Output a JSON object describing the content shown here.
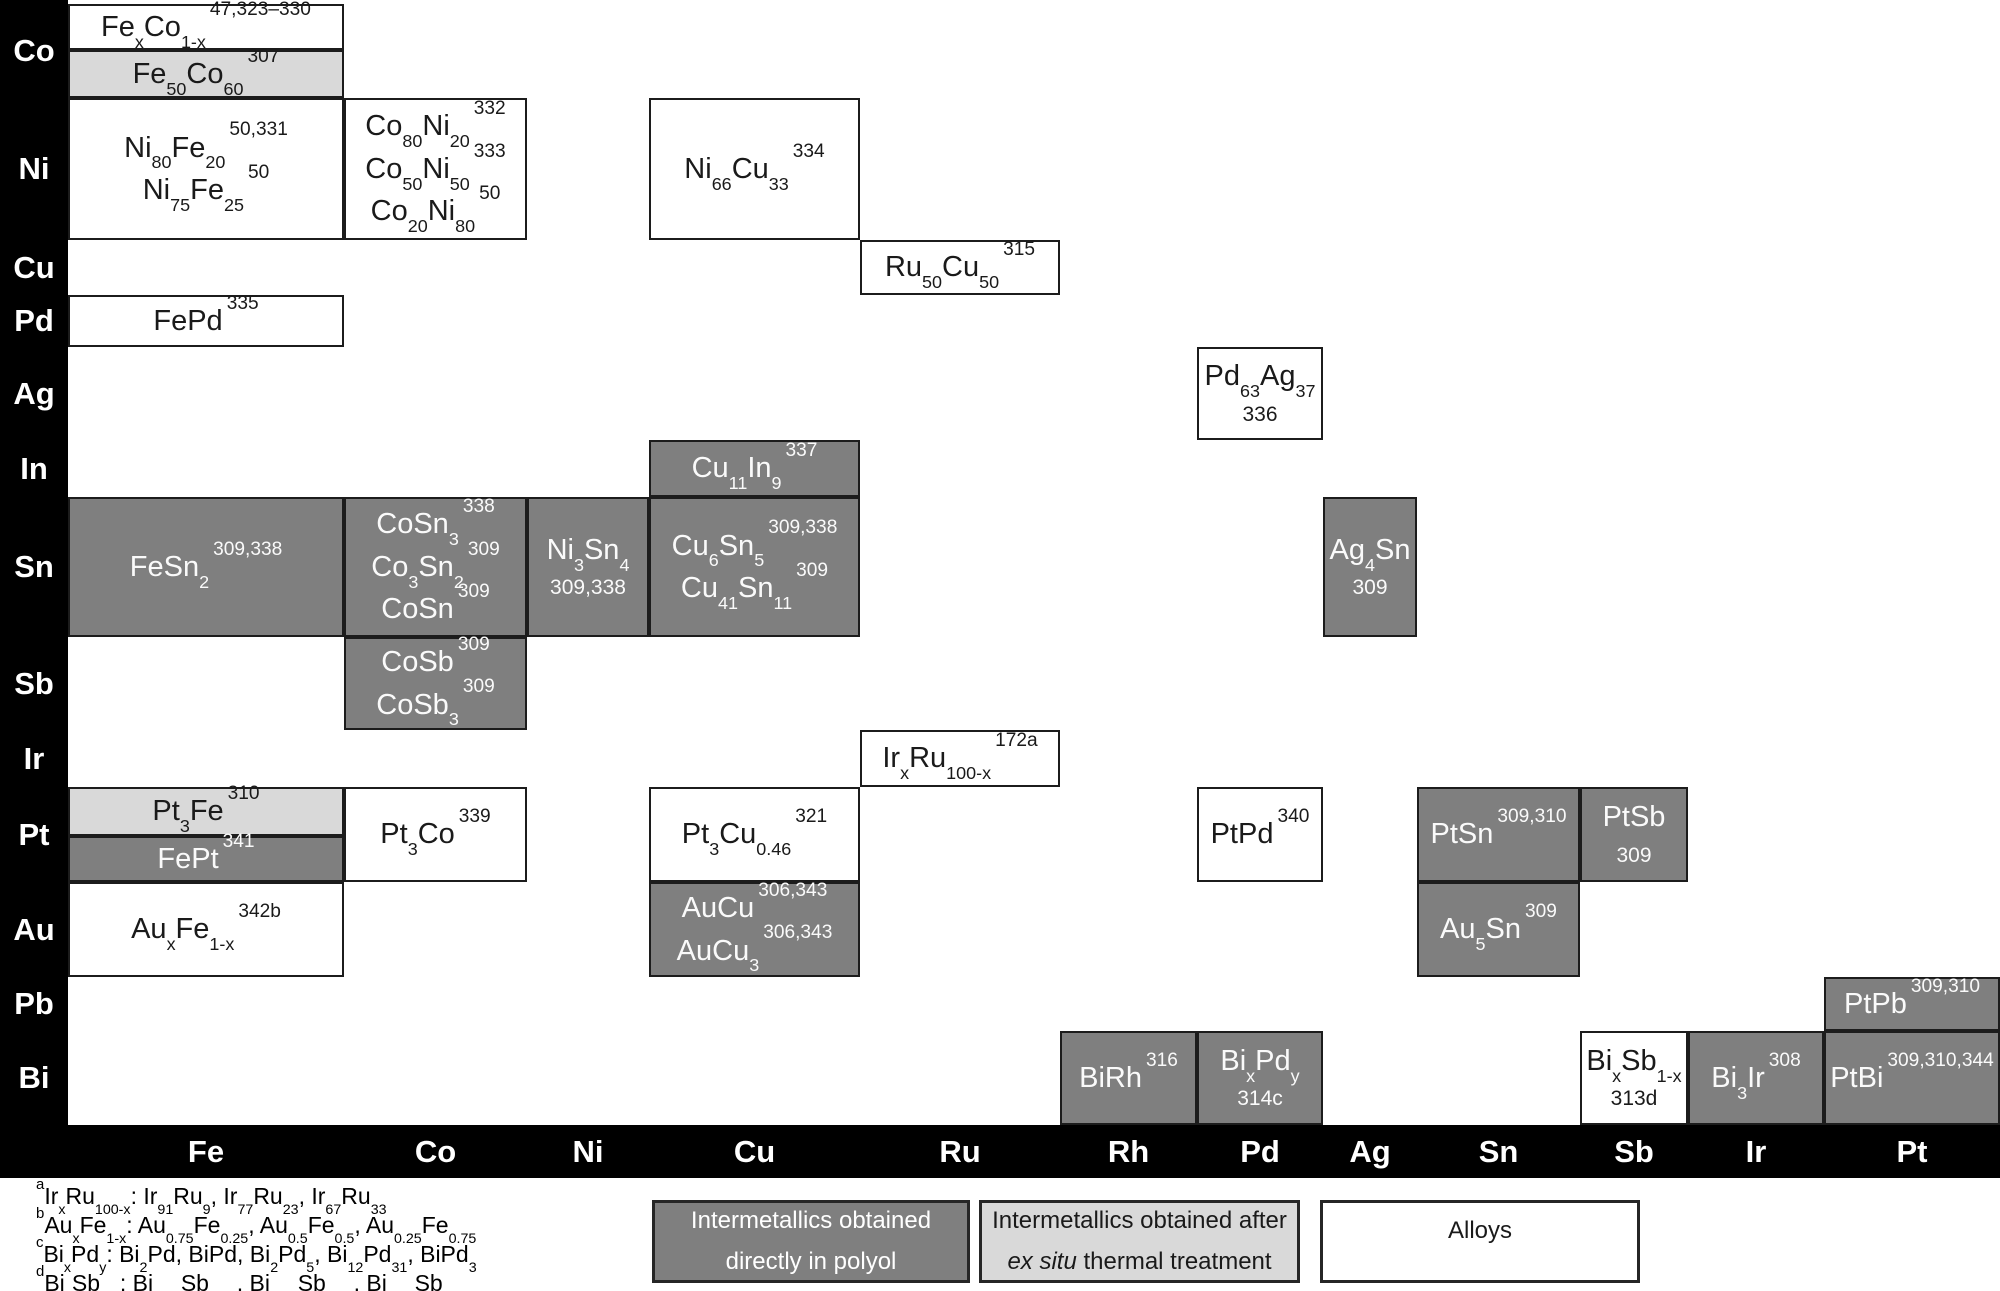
{
  "figure": {
    "row_labels": [
      "Co",
      "Ni",
      "Cu",
      "Pd",
      "Ag",
      "In",
      "Sn",
      "Sb",
      "Ir",
      "Pt",
      "Au",
      "Pb",
      "Bi"
    ],
    "col_labels": [
      "Fe",
      "Co",
      "Ni",
      "Cu",
      "Ru",
      "Rh",
      "Pd",
      "Ag",
      "Sn",
      "Sb",
      "Ir",
      "Pt"
    ],
    "colors": {
      "dark_gray": "#7f7f7f",
      "light_gray": "#d9d9d9",
      "white": "#ffffff",
      "bar_black": "#000000"
    }
  },
  "cells": [
    {
      "row": "Co",
      "col": "Fe",
      "seg": "top",
      "variant": "white",
      "lines": [
        {
          "f": "Fe{x}Co{1-x}",
          "ref": "47,323–330"
        }
      ]
    },
    {
      "row": "Co",
      "col": "Fe",
      "seg": "bottom",
      "variant": "light",
      "lines": [
        {
          "f": "Fe{50}Co{60}",
          "ref": "307"
        }
      ]
    },
    {
      "row": "Ni",
      "col": "Fe",
      "variant": "white",
      "lines": [
        {
          "f": "Ni{80}Fe{20}",
          "ref": "50,331"
        },
        {
          "f": "Ni{75}Fe{25}",
          "ref": "50"
        }
      ]
    },
    {
      "row": "Ni",
      "col": "Co",
      "variant": "white",
      "lines": [
        {
          "f": "Co{80}Ni{20}",
          "ref": "332"
        },
        {
          "f": "Co{50}Ni{50}",
          "ref": "333"
        },
        {
          "f": "Co{20}Ni{80}",
          "ref": "50"
        }
      ]
    },
    {
      "row": "Ni",
      "col": "Cu",
      "variant": "white",
      "lines": [
        {
          "f": "Ni{66}Cu{33}",
          "ref": "334"
        }
      ]
    },
    {
      "row": "Cu",
      "col": "Ru",
      "variant": "white",
      "lines": [
        {
          "f": "Ru{50}Cu{50}",
          "ref": "315"
        }
      ]
    },
    {
      "row": "Pd",
      "col": "Fe",
      "variant": "white",
      "lines": [
        {
          "f": "FePd",
          "ref": "335"
        }
      ]
    },
    {
      "row": "Ag",
      "col": "Pd",
      "variant": "white",
      "lines": [
        {
          "f": "Pd{63}Ag{37}"
        },
        {
          "plain": "336"
        }
      ]
    },
    {
      "row": "In",
      "col": "Cu",
      "variant": "dark",
      "lines": [
        {
          "f": "Cu{11}In{9}",
          "ref": "337"
        }
      ]
    },
    {
      "row": "Sn",
      "col": "Fe",
      "variant": "dark",
      "lines": [
        {
          "f": "FeSn{2}",
          "ref": "309,338"
        }
      ]
    },
    {
      "row": "Sn",
      "col": "Co",
      "variant": "dark",
      "lines": [
        {
          "f": "CoSn{3}",
          "ref": "338"
        },
        {
          "f": "Co{3}Sn{2}",
          "ref": "309"
        },
        {
          "f": "CoSn",
          "ref": "309"
        }
      ]
    },
    {
      "row": "Sn",
      "col": "Ni",
      "variant": "dark",
      "lines": [
        {
          "f": "Ni{3}Sn{4}"
        },
        {
          "plain": "309,338"
        }
      ]
    },
    {
      "row": "Sn",
      "col": "Cu",
      "variant": "dark",
      "lines": [
        {
          "f": "Cu{6}Sn{5}",
          "ref": "309,338"
        },
        {
          "f": "Cu{41}Sn{11}",
          "ref": "309"
        }
      ]
    },
    {
      "row": "Sn",
      "col": "Ag",
      "variant": "dark",
      "lines": [
        {
          "f": "Ag{4}Sn"
        },
        {
          "plain": "309"
        }
      ]
    },
    {
      "row": "Sb",
      "col": "Co",
      "variant": "dark",
      "lines": [
        {
          "f": "CoSb",
          "ref": "309"
        },
        {
          "f": "CoSb{3}",
          "ref": "309"
        }
      ]
    },
    {
      "row": "Ir",
      "col": "Ru",
      "variant": "white",
      "lines": [
        {
          "f": "Ir{x}Ru{100-x}",
          "ref": "172a"
        }
      ]
    },
    {
      "row": "Pt",
      "col": "Fe",
      "seg": "top",
      "variant": "light",
      "lines": [
        {
          "f": "Pt{3}Fe",
          "ref": "310"
        }
      ]
    },
    {
      "row": "Pt",
      "col": "Fe",
      "seg": "bottom",
      "variant": "dark",
      "lines": [
        {
          "f": "FePt",
          "ref": "341"
        }
      ]
    },
    {
      "row": "Pt",
      "col": "Co",
      "variant": "white",
      "lines": [
        {
          "f": "Pt{3}Co",
          "ref": "339"
        }
      ]
    },
    {
      "row": "Pt",
      "col": "Cu",
      "variant": "white",
      "lines": [
        {
          "f": "Pt{3}Cu{0.46}",
          "ref": "321"
        }
      ]
    },
    {
      "row": "Pt",
      "col": "Pd",
      "variant": "white",
      "lines": [
        {
          "f": "PtPd",
          "ref": "340"
        }
      ]
    },
    {
      "row": "Pt",
      "col": "Sn",
      "variant": "dark",
      "lines": [
        {
          "f": "PtSn",
          "ref": "309,310"
        }
      ]
    },
    {
      "row": "Pt",
      "col": "Sb",
      "variant": "dark",
      "lines": [
        {
          "f": "PtSb"
        },
        {
          "plain": "309"
        }
      ]
    },
    {
      "row": "Au",
      "col": "Fe",
      "variant": "white",
      "lines": [
        {
          "f": "Au{x}Fe{1-x}",
          "ref": "342b"
        }
      ]
    },
    {
      "row": "Au",
      "col": "Cu",
      "variant": "dark",
      "lines": [
        {
          "f": "AuCu",
          "ref": "306,343"
        },
        {
          "f": "AuCu{3}",
          "ref": "306,343"
        }
      ]
    },
    {
      "row": "Au",
      "col": "Sn",
      "variant": "dark",
      "lines": [
        {
          "f": "Au{5}Sn",
          "ref": "309"
        }
      ]
    },
    {
      "row": "Pb",
      "col": "Pt",
      "variant": "dark",
      "lines": [
        {
          "f": "PtPb",
          "ref": "309,310"
        }
      ]
    },
    {
      "row": "Bi",
      "col": "Rh",
      "variant": "dark",
      "lines": [
        {
          "f": "BiRh",
          "ref": "316"
        }
      ]
    },
    {
      "row": "Bi",
      "col": "Pd",
      "variant": "dark",
      "lines": [
        {
          "f": "Bi{x}Pd{y}"
        },
        {
          "plain": "314c"
        }
      ]
    },
    {
      "row": "Bi",
      "col": "Sb",
      "variant": "white",
      "lines": [
        {
          "f": "Bi{x}Sb{1-x}"
        },
        {
          "plain": "313d"
        }
      ]
    },
    {
      "row": "Bi",
      "col": "Ir",
      "variant": "dark",
      "lines": [
        {
          "f": "Bi{3}Ir",
          "ref": "308"
        }
      ]
    },
    {
      "row": "Bi",
      "col": "Pt",
      "variant": "dark",
      "lines": [
        {
          "f": "PtBi",
          "ref": "309,310,344"
        }
      ]
    }
  ],
  "footnotes": [
    {
      "marker": "a",
      "text": "Ir{x}Ru{100-x}: Ir{91}Ru{9}, Ir{77}Ru{23}, Ir{67}Ru{33}"
    },
    {
      "marker": "b",
      "text": "Au{x}Fe{1-x}: Au{0.75}Fe{0.25}, Au{0.5}Fe{0.5}, Au{0.25}Fe{0.75}"
    },
    {
      "marker": "c",
      "text": "Bi{x}Pd{y}: Bi{2}Pd, BiPd, Bi{2}Pd{5}, Bi{12}Pd{31}, BiPd{3}"
    },
    {
      "marker": "d",
      "text": "Bi{x}Sb{1-x}: Bi{0.93}Sb{0.07}, Bi{0.85}Sb{0.15}, Bi{0.70}Sb{0.30}"
    }
  ],
  "legend_items": [
    {
      "variant": "dark",
      "lines": [
        [
          {
            "t": "Intermetallics obtained"
          }
        ],
        [
          {
            "t": "directly in polyol"
          }
        ]
      ]
    },
    {
      "variant": "light",
      "lines": [
        [
          {
            "t": "Intermetallics obtained after"
          }
        ],
        [
          {
            "t": "ex situ",
            "italic": true
          },
          {
            "t": " thermal treatment"
          }
        ]
      ]
    },
    {
      "variant": "white",
      "lines": [
        [
          {
            "t": "Alloys"
          }
        ]
      ]
    }
  ]
}
